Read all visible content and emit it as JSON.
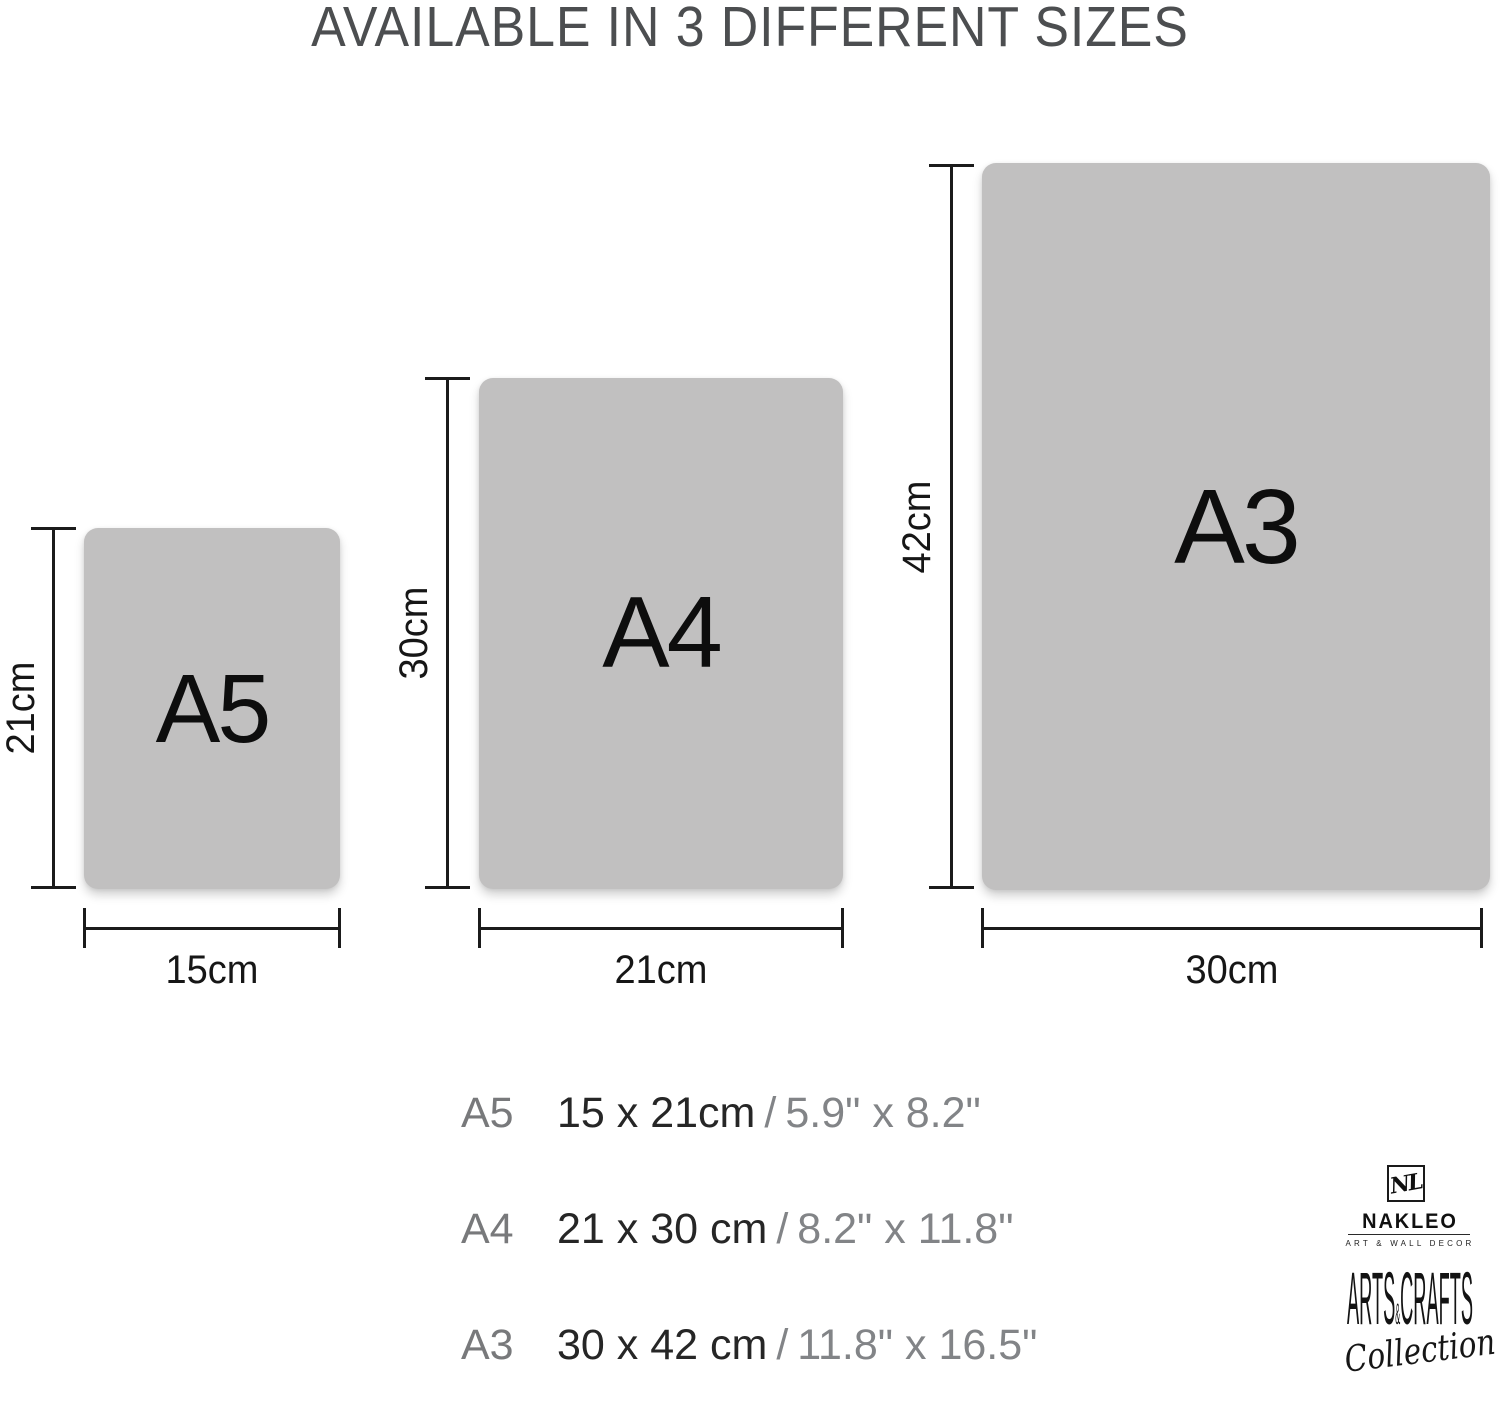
{
  "title": "AVAILABLE IN 3 DIFFERENT SIZES",
  "sizes": [
    {
      "name": "A5",
      "height_label": "21cm",
      "width_label": "15cm"
    },
    {
      "name": "A4",
      "height_label": "30cm",
      "width_label": "21cm"
    },
    {
      "name": "A3",
      "height_label": "42cm",
      "width_label": "30cm"
    }
  ],
  "spec_rows": [
    {
      "name": "A5",
      "cm": "15 x 21cm",
      "sep": "/",
      "inch": "5.9\" x 8.2\""
    },
    {
      "name": "A4",
      "cm": "21 x 30 cm",
      "sep": "/",
      "inch": "8.2\" x 11.8\""
    },
    {
      "name": "A3",
      "cm": "30 x 42 cm",
      "sep": "/",
      "inch": "11.8\" x 16.5\""
    }
  ],
  "brand": {
    "monogram": "NL",
    "name": "NAKLEO",
    "tagline": "ART & WALL DECOR",
    "arts": "ARTS",
    "amp": "&",
    "crafts": "CRAFTS",
    "collection": "Collection"
  },
  "colors": {
    "background": "#ffffff",
    "sheet_fill": "#c1c0c0",
    "title_text": "#4c4e50",
    "dim_lines": "#1b1b1b",
    "black_text": "#161616",
    "muted_text": "#828487"
  }
}
